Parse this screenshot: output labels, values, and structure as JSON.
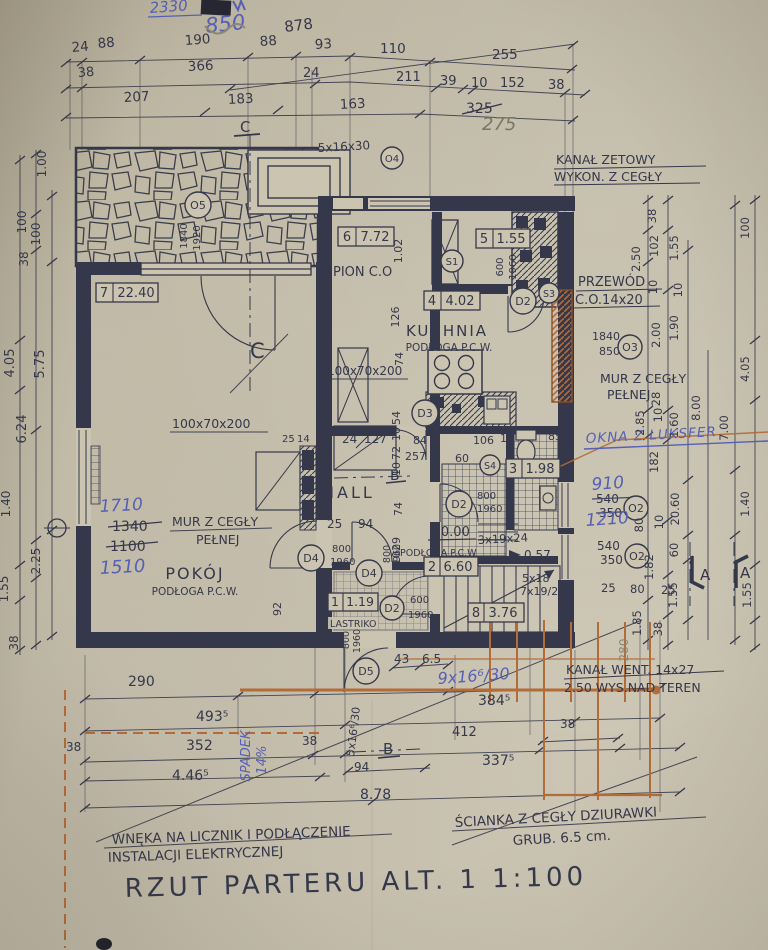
{
  "title": "RZUT PARTERU ALT. 1  1:100",
  "colors": {
    "paper": "#cbc4b1",
    "ink": "#35384a",
    "blue": "#5660b4",
    "orange": "#b26c38",
    "pencil": "#8d8776"
  },
  "top": {
    "blue2330": "2330",
    "blue850": "850",
    "d878": "878",
    "row1": [
      "24",
      "88",
      "190",
      "88",
      "93",
      "110",
      "255"
    ],
    "row2": [
      "38",
      "366",
      "24",
      "211",
      "39",
      "10",
      "152",
      "38"
    ],
    "row3": [
      "207",
      "183",
      "163"
    ],
    "crossed": "325",
    "hand": "275",
    "steps": "5x16x30",
    "cmark": "C",
    "o4": "O4"
  },
  "left": {
    "dims": [
      "1.00",
      "100",
      "100",
      "38",
      "4.05",
      "5.75",
      "6.24",
      "1.40",
      "2.25",
      "1.55",
      "38"
    ]
  },
  "right": {
    "kanal1": "KANAŁ ZETOWY",
    "kanal2": "WYKON. Z CEGŁY",
    "przewod1": "PRZEWÓD",
    "przewod2": "C.O.14x20",
    "mur1": "MUR Z CEGŁY",
    "mur2": "PEŁNEJ",
    "okna": "OKNA Z LUKSFER",
    "v910": "910",
    "v1210": "1210",
    "o2": "O2",
    "o3": "O3",
    "n540": "540",
    "n350": "350",
    "n1840": "1840",
    "n850": "850",
    "kwent1": "KANAŁ WENT. 14x27",
    "kwent2": "2.50 WYS.NAD TEREN",
    "amark": "A",
    "p280": "280",
    "dims": [
      "38",
      "102",
      "2.50",
      "1.55",
      "10",
      "100",
      "10",
      "2.00",
      "1.90",
      "4.05",
      "28",
      "10",
      "2.85",
      "1.60",
      "8.00",
      "7.00",
      "182",
      "80",
      "10",
      "20.60",
      "60",
      "1.82",
      "1.55",
      "38",
      "1.40",
      "1.55",
      "1.85",
      "25",
      "80",
      "25",
      "38"
    ]
  },
  "plan": {
    "r7no": "7",
    "r7a": "22.40",
    "r6no": "6",
    "r6a": "7.72",
    "r5no": "5",
    "r5a": "1.55",
    "r4no": "4",
    "r4a": "4.02",
    "r3no": "3",
    "r3a": "1.98",
    "r2no": "2",
    "r2a": "6.60",
    "r1no": "1",
    "r1a": "1.19",
    "r8no": "8",
    "r8a": "3.76",
    "pokoj": "POKÓJ",
    "pokoj_f": "PODŁOGA P.C.W.",
    "mur1": "MUR Z CEGŁY",
    "mur2": "PEŁNEJ",
    "hall": "HALL",
    "kuchnia": "KUCHNIA",
    "kuchnia_f": "PODŁOGA P.C.W.",
    "r2f": "PODŁOGA P.C.W",
    "r1f": "LASTRIKO",
    "pion": "PION C.O",
    "wardrobe": "100x70x200",
    "level0": "±0.00",
    "level57": "0.57",
    "st3": "3x19x24",
    "st5a": "5x18",
    "st5b": "7x19/24",
    "o5": "O5",
    "n1840": "1840",
    "n1920": "1920",
    "s1": "S1",
    "s2": "S2",
    "s3": "S3",
    "s4": "S4",
    "d2": "D2",
    "d3": "D3",
    "d4": "D4",
    "d5": "D5",
    "n600": "600",
    "n800": "800",
    "n1960": "1960",
    "bmark": "B",
    "cmark": "C",
    "b1710": "1710",
    "c1340": "1340",
    "c1100": "1100",
    "b1510": "1510",
    "dims": [
      "1.02",
      "126",
      "74",
      "54",
      "10",
      "72",
      "10",
      "74",
      "29",
      "10",
      "24",
      "127",
      "25",
      "94",
      "84",
      "257",
      "60",
      "106",
      "10",
      "85",
      "92",
      "25",
      "14",
      "43",
      "6.5"
    ]
  },
  "bottom": {
    "dims": [
      "290",
      "493⁵",
      "38",
      "352",
      "4.46⁵",
      "384⁵",
      "412",
      "337⁵",
      "38",
      "94",
      "8.78"
    ],
    "steps": "5x16⁶/30",
    "blue_steps": "9x16⁶/30",
    "spadek": "SPADEK",
    "spadek2": "14%",
    "wneka1": "WNĘKA NA LICZNIK I PODŁĄCZENIE",
    "wneka2": "INSTALACJI ELEKTRYCZNEJ",
    "scianka1": "ŚCIANKA Z CEGŁY DZIURAWKI",
    "scianka2": "GRUB. 6.5 cm."
  }
}
